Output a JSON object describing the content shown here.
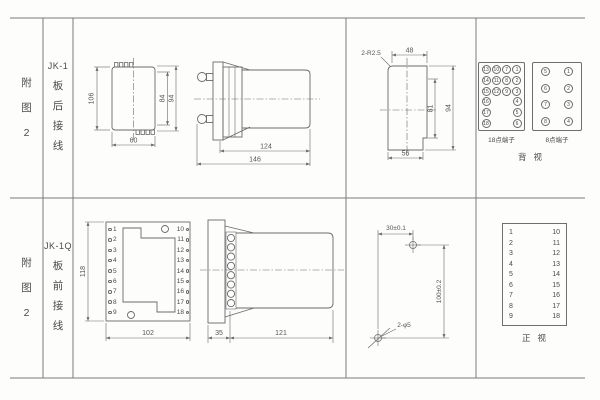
{
  "colors": {
    "background": "#fdfdfc",
    "line": "#6e6e6e",
    "text": "#4f4f4f"
  },
  "row1": {
    "figure_label": "附图2",
    "model": "JK-1",
    "wiring_label": "板后接线",
    "dims": {
      "d106": "106",
      "d84": "84",
      "d94": "94",
      "d60": "60",
      "d124": "124",
      "d146": "146",
      "r25": "2-R2.5",
      "d48": "48",
      "d81": "81",
      "d94b": "94",
      "d56": "56"
    },
    "terminals18": {
      "label": "18点端子",
      "rows": [
        [
          "13",
          "10",
          "7",
          "1"
        ],
        [
          "14",
          "11",
          "8",
          "2"
        ],
        [
          "15",
          "12",
          "9",
          "3"
        ],
        [
          "16",
          "4"
        ],
        [
          "17",
          "5"
        ],
        [
          "18",
          "6"
        ]
      ]
    },
    "terminals8": {
      "label": "8点端子",
      "rows": [
        [
          "5",
          "1"
        ],
        [
          "6",
          "2"
        ],
        [
          "7",
          "3"
        ],
        [
          "8",
          "4"
        ]
      ]
    },
    "view_label": "背视"
  },
  "row2": {
    "figure_label": "附图2",
    "model": "JK-1Q",
    "wiring_label": "板前接线",
    "dims": {
      "d118": "118",
      "d102": "102",
      "d35": "35",
      "d121": "121",
      "d30": "30±0.1",
      "d100": "100±0.2",
      "holes": "2-φ5"
    },
    "front_view": {
      "left_pins": [
        "1",
        "2",
        "3",
        "4",
        "5",
        "6",
        "7",
        "8",
        "9"
      ],
      "right_pins": [
        "10",
        "11",
        "12",
        "13",
        "14",
        "15",
        "16",
        "17",
        "18"
      ]
    },
    "mapping_table": {
      "left": [
        "1",
        "2",
        "3",
        "4",
        "5",
        "6",
        "7",
        "8",
        "9"
      ],
      "right": [
        "10",
        "11",
        "12",
        "13",
        "14",
        "15",
        "16",
        "17",
        "18"
      ]
    },
    "view_label": "正视"
  }
}
